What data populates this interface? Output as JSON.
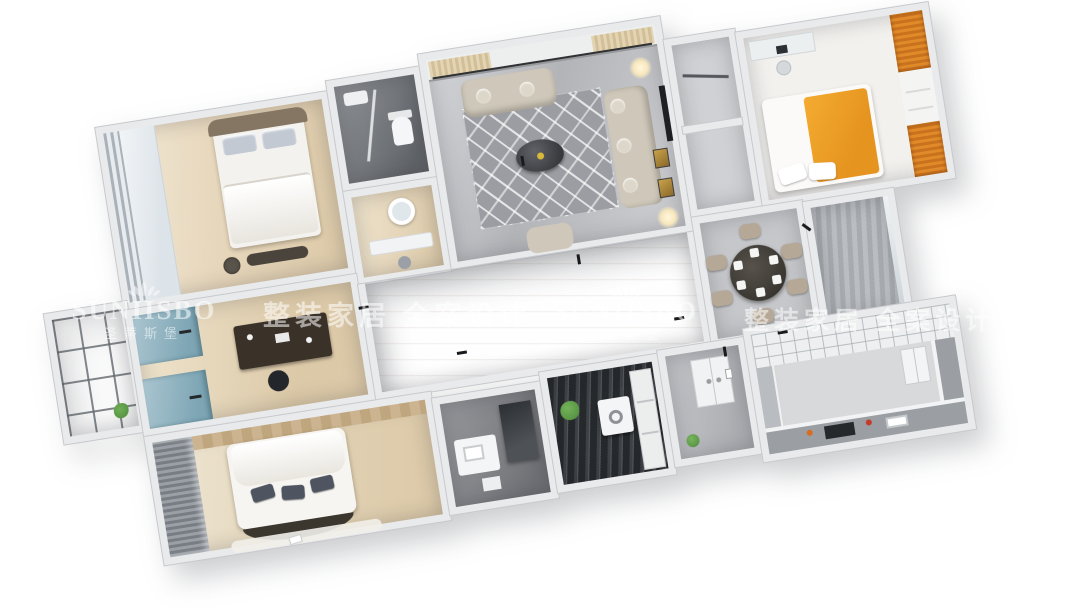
{
  "watermark": {
    "brand": "SUNIISBO",
    "brand_cn": "圣蒂斯堡",
    "slogan": "整装家居 全案设计",
    "separator": "/",
    "logo_icon": "lotus-crown-icon",
    "color": "rgba(255,255,255,0.55)"
  },
  "palette": {
    "background": "#ffffff",
    "wall": "#e9eaec",
    "wall_edge": "#c8c9cd",
    "wood_floor": "#dcc9a8",
    "wood_floor_light": "#efe4cd",
    "marble_floor": "#c6c7ca",
    "dark_tile": "#4a4d51",
    "laundry_floor": "#2f3236",
    "accent_orange": "#e5941f",
    "orange_wood": "#c8721e",
    "teal_cabinet": "#8db3c2",
    "sofa_fabric": "#cfc8ba",
    "dark_furniture": "#35302a",
    "curtain_cream": "#e3d4b4",
    "curtain_gray": "#8b9096",
    "glow": "#f7e7bd",
    "plant_green": "#4e8a3c",
    "gold_frame": "#c9a14b"
  }
}
